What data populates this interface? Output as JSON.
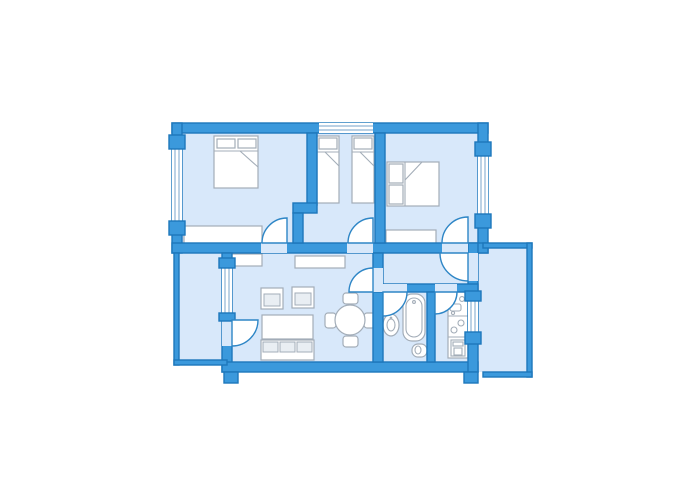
{
  "title": "apartment-floor-plan",
  "colors": {
    "background": "#ffffff",
    "wall": "#3B99DC",
    "wallStroke": "#1D77BB",
    "room": "#D8E8FA",
    "windowLine": "#8FB4D4",
    "doorStroke": "#2E86C6",
    "furnitureFill": "#FFFFFF",
    "furnitureStroke": "#A3ADB8",
    "cushion": "#E9EEF3"
  },
  "rooms": [
    {
      "name": "bedroom-left",
      "furniture": [
        "double-bed",
        "wardrobe"
      ],
      "windows": 1,
      "doors": 1
    },
    {
      "name": "bedroom-middle",
      "furniture": [
        "single-bed",
        "single-bed"
      ],
      "windows": 1,
      "doors": 1
    },
    {
      "name": "bedroom-right",
      "furniture": [
        "double-bed",
        "wardrobe"
      ],
      "windows": 1,
      "doors": 1
    },
    {
      "name": "living-dining-room",
      "furniture": [
        "sideboard",
        "sideboard",
        "armchair",
        "armchair",
        "coffee-table",
        "sofa",
        "dining-table",
        "chair",
        "chair",
        "chair",
        "chair"
      ],
      "windows": 1,
      "doors": 2
    },
    {
      "name": "hallway",
      "furniture": [],
      "windows": 0,
      "doors": 4
    },
    {
      "name": "bathroom",
      "furniture": [
        "wash-basin",
        "bathtub",
        "toilet"
      ],
      "windows": 0,
      "doors": 1
    },
    {
      "name": "kitchen",
      "furniture": [
        "kitchenette-sink",
        "cooktop",
        "oven"
      ],
      "windows": 1,
      "doors": 1
    },
    {
      "name": "balcony-left",
      "furniture": [],
      "windows": 0,
      "doors": 1
    },
    {
      "name": "balcony-right",
      "furniture": [],
      "windows": 0,
      "doors": 1
    }
  ]
}
